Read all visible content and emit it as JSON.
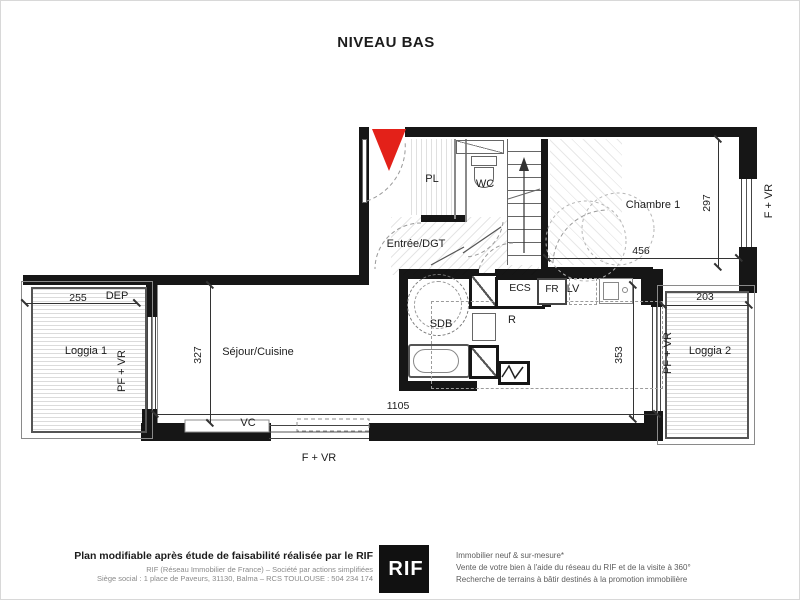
{
  "title": "NIVEAU BAS",
  "rooms": {
    "entree": "Entrée/DGT",
    "pl": "PL",
    "wc": "WC",
    "chambre1": "Chambre 1",
    "loggia1": "Loggia 1",
    "sejour": "Séjour/Cuisine",
    "sdb": "SDB",
    "ecs": "ECS",
    "fr": "FR",
    "lv": "LV",
    "r": "R",
    "loggia2": "Loggia 2"
  },
  "dimensions": {
    "w255": "255",
    "dep": "DEP",
    "h297": "297",
    "w456": "456",
    "w203": "203",
    "h327": "327",
    "h353": "353",
    "w1105": "1105"
  },
  "annotations": {
    "pf_vr_left": "PF + VR",
    "pf_vr_right": "PF + VR",
    "f_vr_right": "F + VR",
    "f_vr_bottom": "F + VR",
    "vc": "VC"
  },
  "footer": {
    "bold_line": "Plan modifiable après étude de faisabilité réalisée par le RIF",
    "small_line1": "RIF (Réseau Immobilier de France) – Société par actions simplifiées",
    "small_line2": "Siège social : 1 place de Paveurs, 31130, Balma – RCS TOULOUSE : 504 234 174",
    "logo_text": "RIF",
    "right_line1": "Immobilier neuf & sur-mesure*",
    "right_line2": "Vente de votre bien à l'aide du réseau du RIF et de la visite à 360°",
    "right_line3": "Recherche de terrains à bâtir destinés à la promotion immobilière"
  },
  "colors": {
    "wall": "#161616",
    "entry_arrow": "#e32119"
  }
}
